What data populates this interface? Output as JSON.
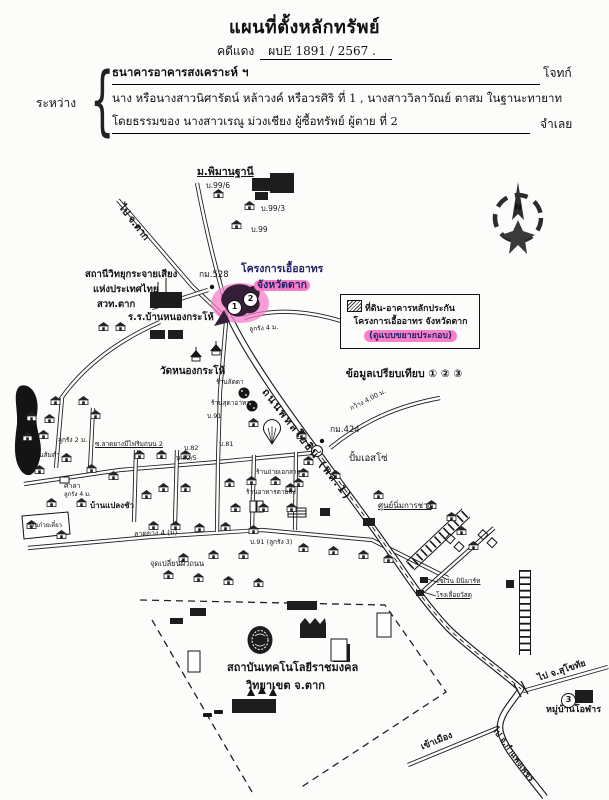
{
  "doc": {
    "title": "แผนที่ตั้งหลักทรัพย์",
    "case_label": "คดีแดง",
    "case_no": "ผบE 1891 / 2567 .",
    "between_label": "ระหว่าง",
    "plaintiff_line": "ธนาคารอาคารสงเคราะห์ ฯ",
    "plaintiff_role": "โจทก์",
    "defendant_line1": "นาง หรือนางสาวนิศารัตน์ หล้าวงค์ หรือวรศิริ ที่ 1 , นางสาววิลาวัณย์ ตาสม ในฐานะทายาท",
    "defendant_line2": "โดยธรรมของ นางสาวเรณู ม่วงเชียง ผู้ซื้อทรัพย์ ผู้ตาย ที่ 2",
    "defendant_role": "จำเลย"
  },
  "legend": {
    "line1": "ที่ดิน-อาคารหลักประกัน",
    "line2": "โครงการเอื้ออาทร จังหวัดตาก",
    "line3": "(ดูแบบขยายประกอบ)",
    "compare": "ข้อมูลเปรียบเทียบ ① ② ③"
  },
  "map": {
    "highlight": "#f87fc9",
    "accent_text": "#232268",
    "compass_label": "N",
    "markers": [
      {
        "n": "1",
        "x": 227,
        "y": 300
      },
      {
        "n": "2",
        "x": 243,
        "y": 292
      },
      {
        "n": "3",
        "x": 561,
        "y": 693
      }
    ],
    "labels": [
      {
        "t": "ม.พิมานฐานี",
        "x": 197,
        "y": 167,
        "fs": 10.5,
        "b": 1,
        "u": 1
      },
      {
        "t": "บ.99/6",
        "x": 206,
        "y": 182,
        "fs": 7.5
      },
      {
        "t": "บ.99/3",
        "x": 261,
        "y": 205,
        "fs": 7.5
      },
      {
        "t": "บ.99",
        "x": 251,
        "y": 226,
        "fs": 7.5
      },
      {
        "t": "ไป จ.ตาก",
        "x": 124,
        "y": 203,
        "fs": 10,
        "b": 1,
        "rot": 52
      },
      {
        "t": "สถานีวิทยุกระจายเสียง",
        "x": 85,
        "y": 270,
        "fs": 9.5,
        "b": 1
      },
      {
        "t": "แห่งประเทศไทย",
        "x": 93,
        "y": 285,
        "fs": 9.5,
        "b": 1
      },
      {
        "t": "สวท.ตาก",
        "x": 97,
        "y": 300,
        "fs": 9.5,
        "b": 1
      },
      {
        "t": "ร.ร.บ้านหนองกระโห้",
        "x": 128,
        "y": 313,
        "fs": 9.5,
        "b": 1
      },
      {
        "t": "กม.528",
        "x": 199,
        "y": 271,
        "fs": 8.5
      },
      {
        "t": "โครงการเอื้ออาทร",
        "x": 241,
        "y": 264,
        "fs": 10.5,
        "b": 1,
        "col": "#232268"
      },
      {
        "t": "จังหวัดตาก",
        "x": 254,
        "y": 280,
        "fs": 10.5,
        "b": 1,
        "col": "#232268",
        "hl": 1
      },
      {
        "t": "ลูกรัง 4 ม.",
        "x": 249,
        "y": 326,
        "fs": 6.5,
        "rot": -4
      },
      {
        "t": "วัดหนองกระโห้",
        "x": 160,
        "y": 367,
        "fs": 10,
        "b": 1
      },
      {
        "t": "ถนนพหลโยธิน (พล.1)",
        "x": 268,
        "y": 387,
        "fs": 10.5,
        "b": 1,
        "rot": 52,
        "ls": 2
      },
      {
        "t": "กว้าง 4.00 ม.",
        "x": 349,
        "y": 406,
        "fs": 6.5,
        "rot": -27
      },
      {
        "t": "กม.424",
        "x": 330,
        "y": 426,
        "fs": 8.5
      },
      {
        "t": "ปั้มเอสโซ่",
        "x": 349,
        "y": 454,
        "fs": 9.5
      },
      {
        "t": "ร้านลัดดา",
        "x": 216,
        "y": 379,
        "fs": 6.5
      },
      {
        "t": "ร้านสุดาอาหาร",
        "x": 211,
        "y": 400,
        "fs": 6.5
      },
      {
        "t": "บ.91",
        "x": 207,
        "y": 413,
        "fs": 6.5
      },
      {
        "t": "ลูกรัง 2 ม.",
        "x": 58,
        "y": 437,
        "fs": 6.5
      },
      {
        "t": "ซ.ลาดยางมีไฟริมถนน 2",
        "x": 95,
        "y": 441,
        "fs": 6.5,
        "u": 1
      },
      {
        "t": "บ.82",
        "x": 184,
        "y": 445,
        "fs": 6.5
      },
      {
        "t": "บ.82/5",
        "x": 176,
        "y": 455,
        "fs": 6.5
      },
      {
        "t": "บ.81",
        "x": 219,
        "y": 441,
        "fs": 6.5
      },
      {
        "t": "ร้านส้มตำ",
        "x": 32,
        "y": 452,
        "fs": 6.5
      },
      {
        "t": "ศาลา",
        "x": 64,
        "y": 483,
        "fs": 7
      },
      {
        "t": "ลูกรัง 4 ม.",
        "x": 64,
        "y": 492,
        "fs": 6
      },
      {
        "t": "บ้านแปลงชัว",
        "x": 90,
        "y": 502,
        "fs": 8,
        "b": 1
      },
      {
        "t": "ร้านก๋วยเตี๋ยว",
        "x": 28,
        "y": 523,
        "fs": 6
      },
      {
        "t": "ลาดยาง 4 (ม)",
        "x": 134,
        "y": 531,
        "fs": 7,
        "rot": -2
      },
      {
        "t": "จุดเปลี่ยนผิวถนน",
        "x": 150,
        "y": 560,
        "fs": 7.5
      },
      {
        "t": "ร้านถ่ายเอกสาร",
        "x": 256,
        "y": 469,
        "fs": 6.5
      },
      {
        "t": "ร้านอาหารตามสั่ง",
        "x": 246,
        "y": 489,
        "fs": 6.5
      },
      {
        "t": "บ.91 (ลูกรัง 3)",
        "x": 250,
        "y": 539,
        "fs": 6.5
      },
      {
        "t": "ศูนย์นิ่มการช่าง",
        "x": 378,
        "y": 502,
        "fs": 8,
        "u": 1
      },
      {
        "t": "เซเว่น มินิมาร์ท",
        "x": 437,
        "y": 578,
        "fs": 6.5,
        "u": 1
      },
      {
        "t": "โรงเลื่อยวัสดุ",
        "x": 436,
        "y": 592,
        "fs": 6.5,
        "u": 1
      },
      {
        "t": "สถาบันเทคโนโลยีราชมงคล",
        "x": 227,
        "y": 662,
        "fs": 11,
        "b": 1
      },
      {
        "t": "วิทยาเขต จ.ตาก",
        "x": 246,
        "y": 680,
        "fs": 11,
        "b": 1
      },
      {
        "t": "ไป จ.สุโขทัย",
        "x": 537,
        "y": 675,
        "fs": 9,
        "b": 1,
        "rot": -18
      },
      {
        "t": "หมู่บ้านโอฬาร",
        "x": 546,
        "y": 706,
        "fs": 9,
        "b": 1
      },
      {
        "t": "เข้าเมือง",
        "x": 420,
        "y": 744,
        "fs": 9,
        "b": 1,
        "rot": -22
      },
      {
        "t": "ไป จ.กำแพงเพชร",
        "x": 497,
        "y": 726,
        "fs": 8.5,
        "b": 1,
        "rot": 54
      }
    ],
    "houses": [
      [
        213,
        189
      ],
      [
        244,
        201
      ],
      [
        231,
        220
      ],
      [
        98,
        322
      ],
      [
        115,
        322
      ],
      [
        50,
        396
      ],
      [
        78,
        396
      ],
      [
        26,
        412
      ],
      [
        44,
        414
      ],
      [
        90,
        410
      ],
      [
        38,
        430
      ],
      [
        22,
        432
      ],
      [
        61,
        453
      ],
      [
        34,
        465
      ],
      [
        86,
        464
      ],
      [
        108,
        471
      ],
      [
        134,
        450
      ],
      [
        156,
        450
      ],
      [
        180,
        450
      ],
      [
        46,
        498
      ],
      [
        76,
        498
      ],
      [
        141,
        490
      ],
      [
        158,
        483
      ],
      [
        180,
        483
      ],
      [
        26,
        520
      ],
      [
        56,
        530
      ],
      [
        148,
        521
      ],
      [
        170,
        521
      ],
      [
        194,
        523
      ],
      [
        220,
        522
      ],
      [
        248,
        525
      ],
      [
        224,
        478
      ],
      [
        246,
        476
      ],
      [
        270,
        476
      ],
      [
        293,
        478
      ],
      [
        230,
        503
      ],
      [
        258,
        503
      ],
      [
        286,
        503
      ],
      [
        248,
        418
      ],
      [
        296,
        430
      ],
      [
        303,
        456
      ],
      [
        330,
        470
      ],
      [
        373,
        490
      ],
      [
        426,
        500
      ],
      [
        446,
        512
      ],
      [
        456,
        526
      ],
      [
        468,
        541
      ],
      [
        298,
        543
      ],
      [
        328,
        546
      ],
      [
        358,
        550
      ],
      [
        383,
        554
      ],
      [
        238,
        550
      ],
      [
        208,
        550
      ],
      [
        178,
        553
      ],
      [
        163,
        570
      ],
      [
        193,
        573
      ],
      [
        223,
        576
      ],
      [
        253,
        578
      ],
      [
        298,
        468
      ],
      [
        285,
        483
      ]
    ],
    "dark_buildings": [
      [
        252,
        178,
        20,
        13
      ],
      [
        270,
        173,
        24,
        20
      ],
      [
        255,
        192,
        13,
        8
      ],
      [
        150,
        292,
        32,
        16
      ],
      [
        150,
        330,
        15,
        9
      ],
      [
        168,
        330,
        15,
        9
      ],
      [
        287,
        601,
        30,
        9
      ],
      [
        300,
        624,
        26,
        14
      ],
      [
        333,
        644,
        17,
        18
      ],
      [
        232,
        699,
        44,
        14
      ],
      [
        190,
        608,
        16,
        8
      ],
      [
        170,
        618,
        13,
        6
      ],
      [
        575,
        690,
        18,
        13
      ],
      [
        363,
        518,
        12,
        8
      ],
      [
        420,
        577,
        8,
        6
      ],
      [
        416,
        590,
        8,
        6
      ],
      [
        506,
        580,
        8,
        8
      ],
      [
        320,
        508,
        10,
        8
      ]
    ],
    "white_buildings": [
      [
        377,
        613,
        14,
        24
      ],
      [
        331,
        639,
        16,
        22
      ],
      [
        188,
        651,
        12,
        21
      ],
      [
        250,
        501,
        6,
        11
      ],
      [
        257,
        501,
        6,
        11
      ],
      [
        60,
        477,
        9,
        6
      ]
    ]
  }
}
